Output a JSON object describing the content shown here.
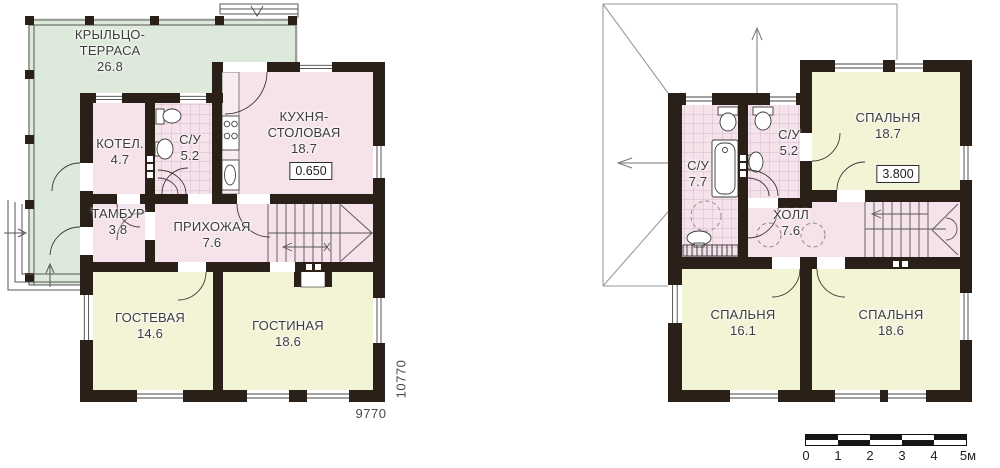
{
  "first_floor": {
    "rooms": [
      {
        "name": "КРЫЛЬЦО-\nТЕРРАСА",
        "area": "26.8"
      },
      {
        "name": "КОТЕЛ.",
        "area": "4.7"
      },
      {
        "name": "С/У",
        "area": "5.2"
      },
      {
        "name": "КУХНЯ-\nСТОЛОВАЯ",
        "area": "18.7"
      },
      {
        "name": "ТАМБУР",
        "area": "3.8"
      },
      {
        "name": "ПРИХОЖАЯ",
        "area": "7.6"
      },
      {
        "name": "ГОСТЕВАЯ",
        "area": "14.6"
      },
      {
        "name": "ГОСТИНАЯ",
        "area": "18.6"
      }
    ],
    "floor_level": "0.650",
    "overall_width_mm": "9770",
    "overall_depth_mm": "10770"
  },
  "second_floor": {
    "rooms": [
      {
        "name": "С/У",
        "area": "7.7"
      },
      {
        "name": "С/У",
        "area": "5.2"
      },
      {
        "name": "СПАЛЬНЯ",
        "area": "18.7"
      },
      {
        "name": "ХОЛЛ",
        "area": "7.6"
      },
      {
        "name": "СПАЛЬНЯ",
        "area": "16.1"
      },
      {
        "name": "СПАЛЬНЯ",
        "area": "18.6"
      }
    ],
    "floor_level": "3.800"
  },
  "scale_bar": {
    "labels": [
      "0",
      "1",
      "2",
      "3",
      "4",
      "5м"
    ]
  },
  "colors": {
    "wall": "#2b2017",
    "room_pink": "#f6e2eb",
    "room_yellow": "#f3f3d6",
    "terrace_green": "#dde9da"
  }
}
